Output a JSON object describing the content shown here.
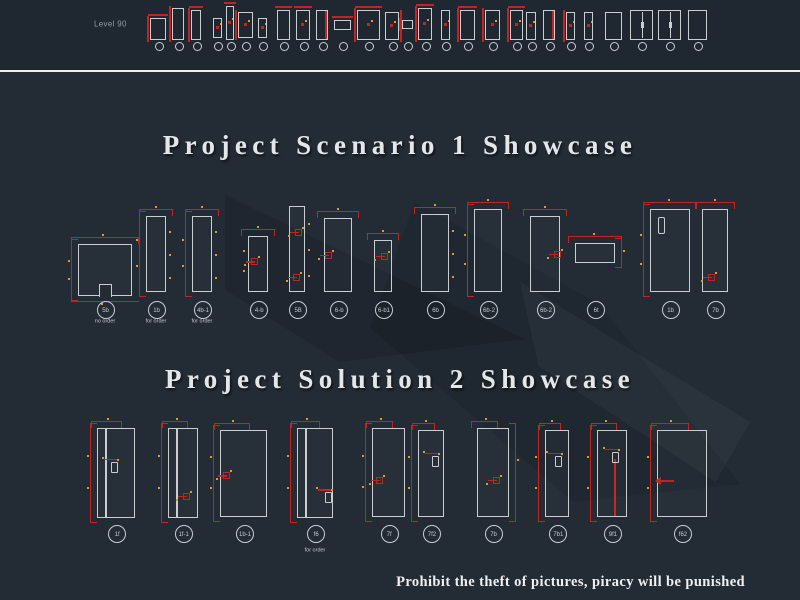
{
  "colors": {
    "background": "#232b35",
    "strip_background": "#1f2731",
    "outline": "#c9ced3",
    "dimension_red": "#c42421",
    "tick_orange": "#dc9a33",
    "title_text": "#e4e7ea",
    "label_text": "#c6cbd1",
    "footer_text": "#eef0f2"
  },
  "top_strip": {
    "level_label": "Level 90",
    "circle_y": 45,
    "items": [
      {
        "x": 150,
        "y": 18,
        "w": 16,
        "h": 22,
        "accents": [
          "redL",
          "redT"
        ]
      },
      {
        "x": 172,
        "y": 8,
        "w": 12,
        "h": 32,
        "accents": [
          "redL"
        ]
      },
      {
        "x": 191,
        "y": 10,
        "w": 10,
        "h": 30,
        "accents": [
          "redL",
          "redT"
        ]
      },
      {
        "x": 213,
        "y": 18,
        "w": 9,
        "h": 20,
        "accents": [
          "redMid"
        ]
      },
      {
        "x": 226,
        "y": 6,
        "w": 8,
        "h": 34,
        "accents": [
          "redT",
          "redMid"
        ]
      },
      {
        "x": 238,
        "y": 12,
        "w": 15,
        "h": 26,
        "accents": [
          "redL",
          "redMid"
        ]
      },
      {
        "x": 258,
        "y": 18,
        "w": 9,
        "h": 20,
        "accents": [
          "redMid"
        ]
      },
      {
        "x": 277,
        "y": 10,
        "w": 13,
        "h": 30,
        "accents": [
          "redT"
        ]
      },
      {
        "x": 296,
        "y": 10,
        "w": 14,
        "h": 30,
        "accents": [
          "redT",
          "redMid"
        ]
      },
      {
        "x": 316,
        "y": 10,
        "w": 12,
        "h": 30,
        "accents": [
          "redRfill"
        ]
      },
      {
        "x": 334,
        "y": 20,
        "w": 17,
        "h": 10,
        "accents": [
          "redT"
        ]
      },
      {
        "x": 357,
        "y": 10,
        "w": 23,
        "h": 30,
        "accents": [
          "redL",
          "redMid",
          "redT"
        ]
      },
      {
        "x": 385,
        "y": 12,
        "w": 14,
        "h": 28,
        "accents": [
          "redMid",
          "redR"
        ]
      },
      {
        "x": 402,
        "y": 20,
        "w": 11,
        "h": 9,
        "accents": [
          "redL"
        ]
      },
      {
        "x": 418,
        "y": 8,
        "w": 14,
        "h": 32,
        "accents": [
          "redL",
          "redMid",
          "redT"
        ]
      },
      {
        "x": 441,
        "y": 10,
        "w": 9,
        "h": 30,
        "accents": [
          "redMid"
        ]
      },
      {
        "x": 460,
        "y": 10,
        "w": 15,
        "h": 30,
        "accents": [
          "redL",
          "redT"
        ]
      },
      {
        "x": 485,
        "y": 10,
        "w": 15,
        "h": 30,
        "accents": [
          "redL",
          "redMid"
        ]
      },
      {
        "x": 510,
        "y": 10,
        "w": 13,
        "h": 30,
        "accents": [
          "redL",
          "redT",
          "redMid"
        ]
      },
      {
        "x": 526,
        "y": 12,
        "w": 10,
        "h": 28,
        "accents": [
          "redMid"
        ]
      },
      {
        "x": 543,
        "y": 10,
        "w": 12,
        "h": 30,
        "accents": [
          "redRfill"
        ]
      },
      {
        "x": 566,
        "y": 12,
        "w": 9,
        "h": 28,
        "accents": [
          "redL",
          "redMid"
        ]
      },
      {
        "x": 584,
        "y": 12,
        "w": 9,
        "h": 28,
        "accents": [
          "redMid"
        ]
      },
      {
        "x": 605,
        "y": 12,
        "w": 17,
        "h": 28,
        "accents": []
      },
      {
        "x": 630,
        "y": 10,
        "w": 23,
        "h": 30,
        "accents": [
          "double"
        ]
      },
      {
        "x": 658,
        "y": 10,
        "w": 23,
        "h": 30,
        "accents": [
          "double"
        ]
      },
      {
        "x": 688,
        "y": 10,
        "w": 19,
        "h": 30,
        "accents": []
      }
    ]
  },
  "sections": [
    {
      "id": "scenario1",
      "title": "Project Scenario 1 Showcase",
      "label_y": 309,
      "sub_y": 322,
      "items": [
        {
          "x": 78,
          "y": 244,
          "w": 54,
          "h": 52,
          "label": "5b",
          "sub": "no order",
          "feats": [
            "dimL",
            "dimT",
            "dimB",
            "notch"
          ]
        },
        {
          "x": 146,
          "y": 216,
          "w": 20,
          "h": 76,
          "label": "1b",
          "sub": "for order",
          "feats": [
            "dimL",
            "dimT",
            "ticksR"
          ]
        },
        {
          "x": 192,
          "y": 216,
          "w": 20,
          "h": 76,
          "label": "4b-1",
          "sub": "for order",
          "feats": [
            "dimL",
            "dimT",
            "ticksR"
          ]
        },
        {
          "x": 248,
          "y": 236,
          "w": 20,
          "h": 56,
          "label": "4-b",
          "feats": [
            "dimT",
            "ticksL"
          ],
          "handle": {
            "style": "red",
            "fx": 0.25,
            "fy": 0.45
          }
        },
        {
          "x": 289,
          "y": 206,
          "w": 16,
          "h": 86,
          "label": "5B",
          "feats": [
            "ticksR"
          ],
          "handle": {
            "style": "red",
            "fx": 0.5,
            "fy": 0.3
          },
          "handle2": {
            "style": "red",
            "fx": 0.4,
            "fy": 0.82
          }
        },
        {
          "x": 324,
          "y": 218,
          "w": 28,
          "h": 74,
          "label": "6-b",
          "feats": [
            "dimT"
          ],
          "handle": {
            "style": "red",
            "fx": 0.12,
            "fy": 0.5
          }
        },
        {
          "x": 374,
          "y": 240,
          "w": 18,
          "h": 52,
          "label": "6-b1",
          "feats": [
            "dimT"
          ],
          "handle": {
            "style": "red",
            "fx": 0.5,
            "fy": 0.3
          }
        },
        {
          "x": 421,
          "y": 214,
          "w": 28,
          "h": 78,
          "label": "6b",
          "feats": [
            "dimT",
            "ticksR"
          ]
        },
        {
          "x": 474,
          "y": 209,
          "w": 28,
          "h": 83,
          "label": "6b-2",
          "feats": [
            "dimT",
            "dimL"
          ]
        },
        {
          "x": 530,
          "y": 216,
          "w": 30,
          "h": 76,
          "label": "6b-2",
          "feats": [
            "dimT"
          ],
          "handle": {
            "style": "red",
            "fx": 0.88,
            "fy": 0.5
          }
        },
        {
          "x": 575,
          "y": 243,
          "w": 40,
          "h": 20,
          "label": "6t",
          "feats": [
            "dimT",
            "dimR"
          ]
        },
        {
          "x": 650,
          "y": 209,
          "w": 40,
          "h": 83,
          "label": "1b",
          "feats": [
            "dimL",
            "dimT",
            "slot"
          ]
        },
        {
          "x": 702,
          "y": 209,
          "w": 26,
          "h": 83,
          "label": "7b",
          "feats": [
            "dimT"
          ],
          "handle": {
            "style": "red",
            "fx": 0.3,
            "fy": 0.82
          }
        }
      ]
    },
    {
      "id": "solution2",
      "title": "Project Solution 2 Showcase",
      "label_y": 533,
      "sub_y": 551,
      "items": [
        {
          "x": 97,
          "y": 428,
          "w": 38,
          "h": 90,
          "label": "1f",
          "feats": [
            "dimL",
            "dimTS",
            "jambL"
          ],
          "handle": {
            "style": "sq",
            "fx": 0.42,
            "fy": 0.42
          }
        },
        {
          "x": 168,
          "y": 428,
          "w": 30,
          "h": 90,
          "label": "1f-1",
          "feats": [
            "dimL",
            "dimTS",
            "jambL"
          ],
          "handle": {
            "style": "red",
            "fx": 0.55,
            "fy": 0.75
          }
        },
        {
          "x": 220,
          "y": 430,
          "w": 47,
          "h": 87,
          "label": "1b-1",
          "feats": [
            "dimL",
            "dimTS"
          ],
          "handle": {
            "style": "red",
            "fx": 0.1,
            "fy": 0.52
          }
        },
        {
          "x": 297,
          "y": 428,
          "w": 36,
          "h": 90,
          "label": "f6",
          "sub": "for order",
          "feats": [
            "dimL",
            "dimTS",
            "jambL"
          ],
          "handle": {
            "style": "sq",
            "fx": 0.82,
            "fy": 0.76
          }
        },
        {
          "x": 372,
          "y": 428,
          "w": 33,
          "h": 89,
          "label": "7f",
          "feats": [
            "dimL",
            "dimTS"
          ],
          "handle": {
            "style": "red",
            "fx": 0.18,
            "fy": 0.58
          }
        },
        {
          "x": 418,
          "y": 430,
          "w": 26,
          "h": 87,
          "label": "7f2",
          "feats": [
            "dimL",
            "dimTS"
          ],
          "handle": {
            "style": "sq",
            "fx": 0.62,
            "fy": 0.34
          }
        },
        {
          "x": 477,
          "y": 428,
          "w": 32,
          "h": 89,
          "label": "7b",
          "feats": [
            "dimR",
            "dimTS"
          ],
          "handle": {
            "style": "red",
            "fx": 0.55,
            "fy": 0.58
          }
        },
        {
          "x": 545,
          "y": 430,
          "w": 24,
          "h": 87,
          "label": "7b1",
          "feats": [
            "dimL",
            "dimTS"
          ],
          "handle": {
            "style": "sq",
            "fx": 0.5,
            "fy": 0.34
          }
        },
        {
          "x": 597,
          "y": 430,
          "w": 30,
          "h": 87,
          "label": "9f1",
          "feats": [
            "dimL",
            "dimTS",
            "leafRed"
          ],
          "handle": {
            "style": "sq",
            "fx": 0.56,
            "fy": 0.3
          }
        },
        {
          "x": 657,
          "y": 430,
          "w": 50,
          "h": 87,
          "label": "f62",
          "feats": [
            "dimL",
            "dimTS"
          ],
          "handle": {
            "style": "arrow",
            "fx": 0.12,
            "fy": 0.58
          }
        }
      ]
    }
  ],
  "footer": {
    "text": "Prohibit the theft of pictures, piracy will be punished"
  }
}
